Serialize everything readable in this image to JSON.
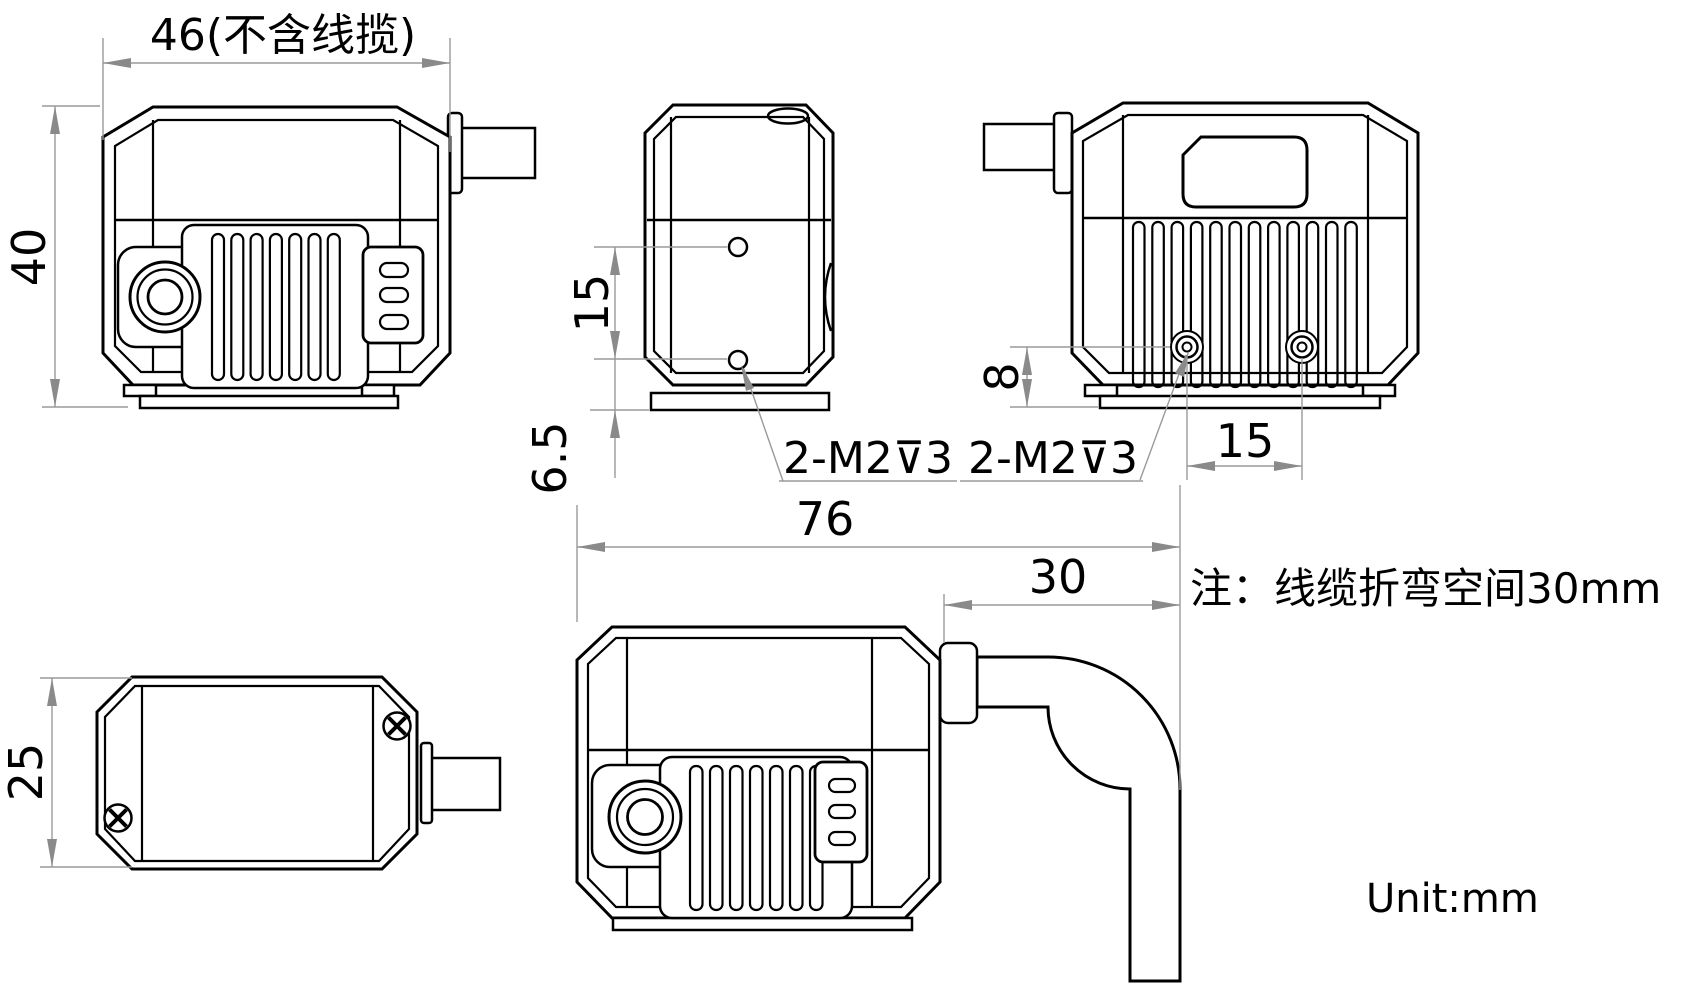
{
  "drawing": {
    "note": "注：线缆折弯空间30mm",
    "unit": "Unit:mm",
    "front_view": {
      "width": "46(不含线揽)",
      "height": "40"
    },
    "side_view": {
      "hole_spacing": "15",
      "hole_bottom_offset": "6.5",
      "thread_callout": "2-M2⊽3"
    },
    "rear_view": {
      "hole_height": "8",
      "hole_spacing": "15",
      "thread_callout": "2-M2⊽3"
    },
    "top_view": {
      "depth": "25"
    },
    "front_cable_view": {
      "overall_length": "76",
      "bend_space": "30"
    }
  }
}
